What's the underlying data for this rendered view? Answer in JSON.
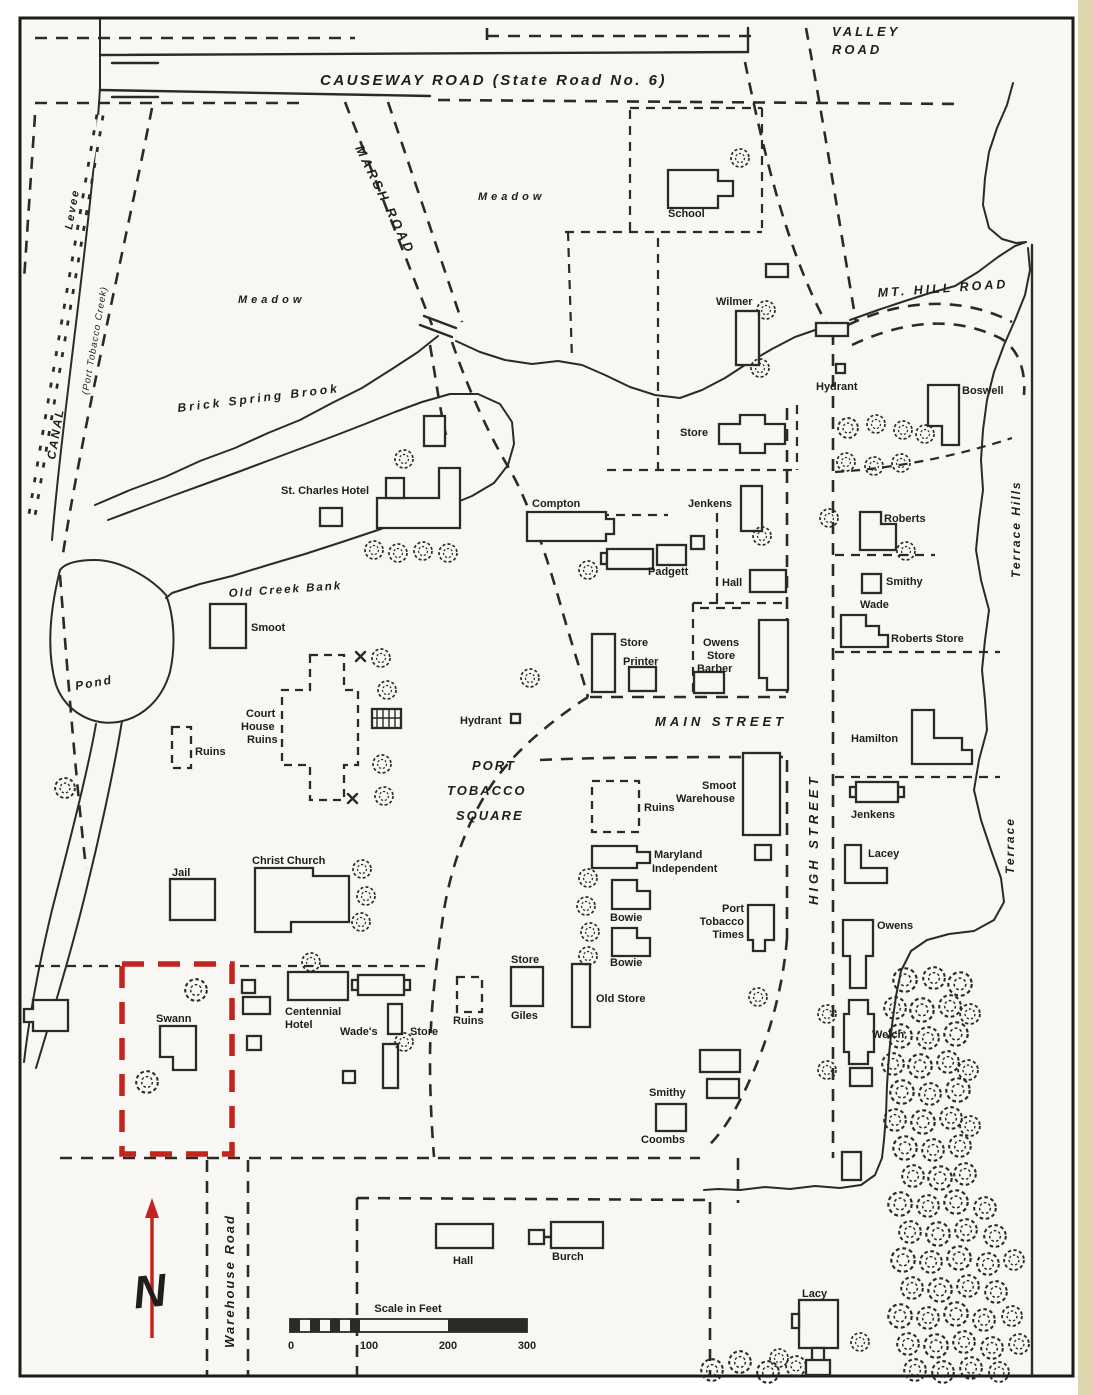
{
  "colors": {
    "ink": "#2b2a26",
    "paper": "#f8f7f3",
    "highlight_red": "#c3241e"
  },
  "roads": {
    "causeway": "CAUSEWAY ROAD (State Road No. 6)",
    "valley": [
      "VALLEY",
      "ROAD"
    ],
    "marsh": "MARSH ROAD",
    "mt_hill": "MT. HILL ROAD",
    "main": "MAIN STREET",
    "high": "HIGH STREET",
    "warehouse": "Warehouse Road",
    "port_tobacco_square": [
      "PORT",
      "TOBACCO",
      "SQUARE"
    ]
  },
  "water": {
    "levee": "Levee",
    "canal": "CANAL",
    "canal_detail": "(Port Tobacco Creek)",
    "brook": "Brick Spring Brook",
    "old_creek_bank": "Old Creek Bank",
    "pond": "Pond"
  },
  "areas": {
    "meadow_upper": "Meadow",
    "meadow_lower": "Meadow",
    "terrace_hills": "Terrace Hills",
    "terrace": "Terrace"
  },
  "markers": {
    "hydrant_north": "Hydrant",
    "hydrant_square": "Hydrant"
  },
  "buildings": {
    "school": "School",
    "wilmer": "Wilmer",
    "boswell": "Boswell",
    "store_north": "Store",
    "st_charles_hotel": "St. Charles Hotel",
    "compton": "Compton",
    "jenkens_main": "Jenkens",
    "padgett": "Padgett",
    "hall_main": "Hall",
    "roberts": "Roberts",
    "smithy_wade": [
      "Smithy",
      "Wade"
    ],
    "roberts_store": "Roberts Store",
    "smoot": "Smoot",
    "ruins_west": "Ruins",
    "court_house_ruins": [
      "Court",
      "House",
      "Ruins"
    ],
    "store_printer": [
      "Store",
      "Printer"
    ],
    "owens_store_barber": [
      "Owens",
      "Store",
      "Barber"
    ],
    "hamilton": "Hamilton",
    "smoot_warehouse": [
      "Smoot",
      "Warehouse"
    ],
    "ruins_square": "Ruins",
    "maryland_independent": [
      "Maryland",
      "Independent"
    ],
    "bowie_upper": "Bowie",
    "bowie_lower": "Bowie",
    "port_tobacco_times": [
      "Port",
      "Tobacco",
      "Times"
    ],
    "jenkens_east": "Jenkens",
    "lacey": "Lacey",
    "christ_church": "Christ Church",
    "jail": "Jail",
    "owens_east": "Owens",
    "welch": "Welch",
    "swann": "Swann",
    "centennial_hotel": [
      "Centennial",
      "Hotel"
    ],
    "wades": "Wade's",
    "wades_store": "Store",
    "giles_store": [
      "Store",
      "Giles"
    ],
    "ruins_giles": "Ruins",
    "old_store": "Old Store",
    "smithy_coombs": [
      "Smithy",
      "Coombs"
    ],
    "hall_south": "Hall",
    "burch": "Burch",
    "lacy": "Lacy"
  },
  "compass": {
    "north": "N"
  },
  "scale_bar": {
    "title": "Scale in Feet",
    "ticks": [
      "0",
      "100",
      "200",
      "300"
    ]
  }
}
